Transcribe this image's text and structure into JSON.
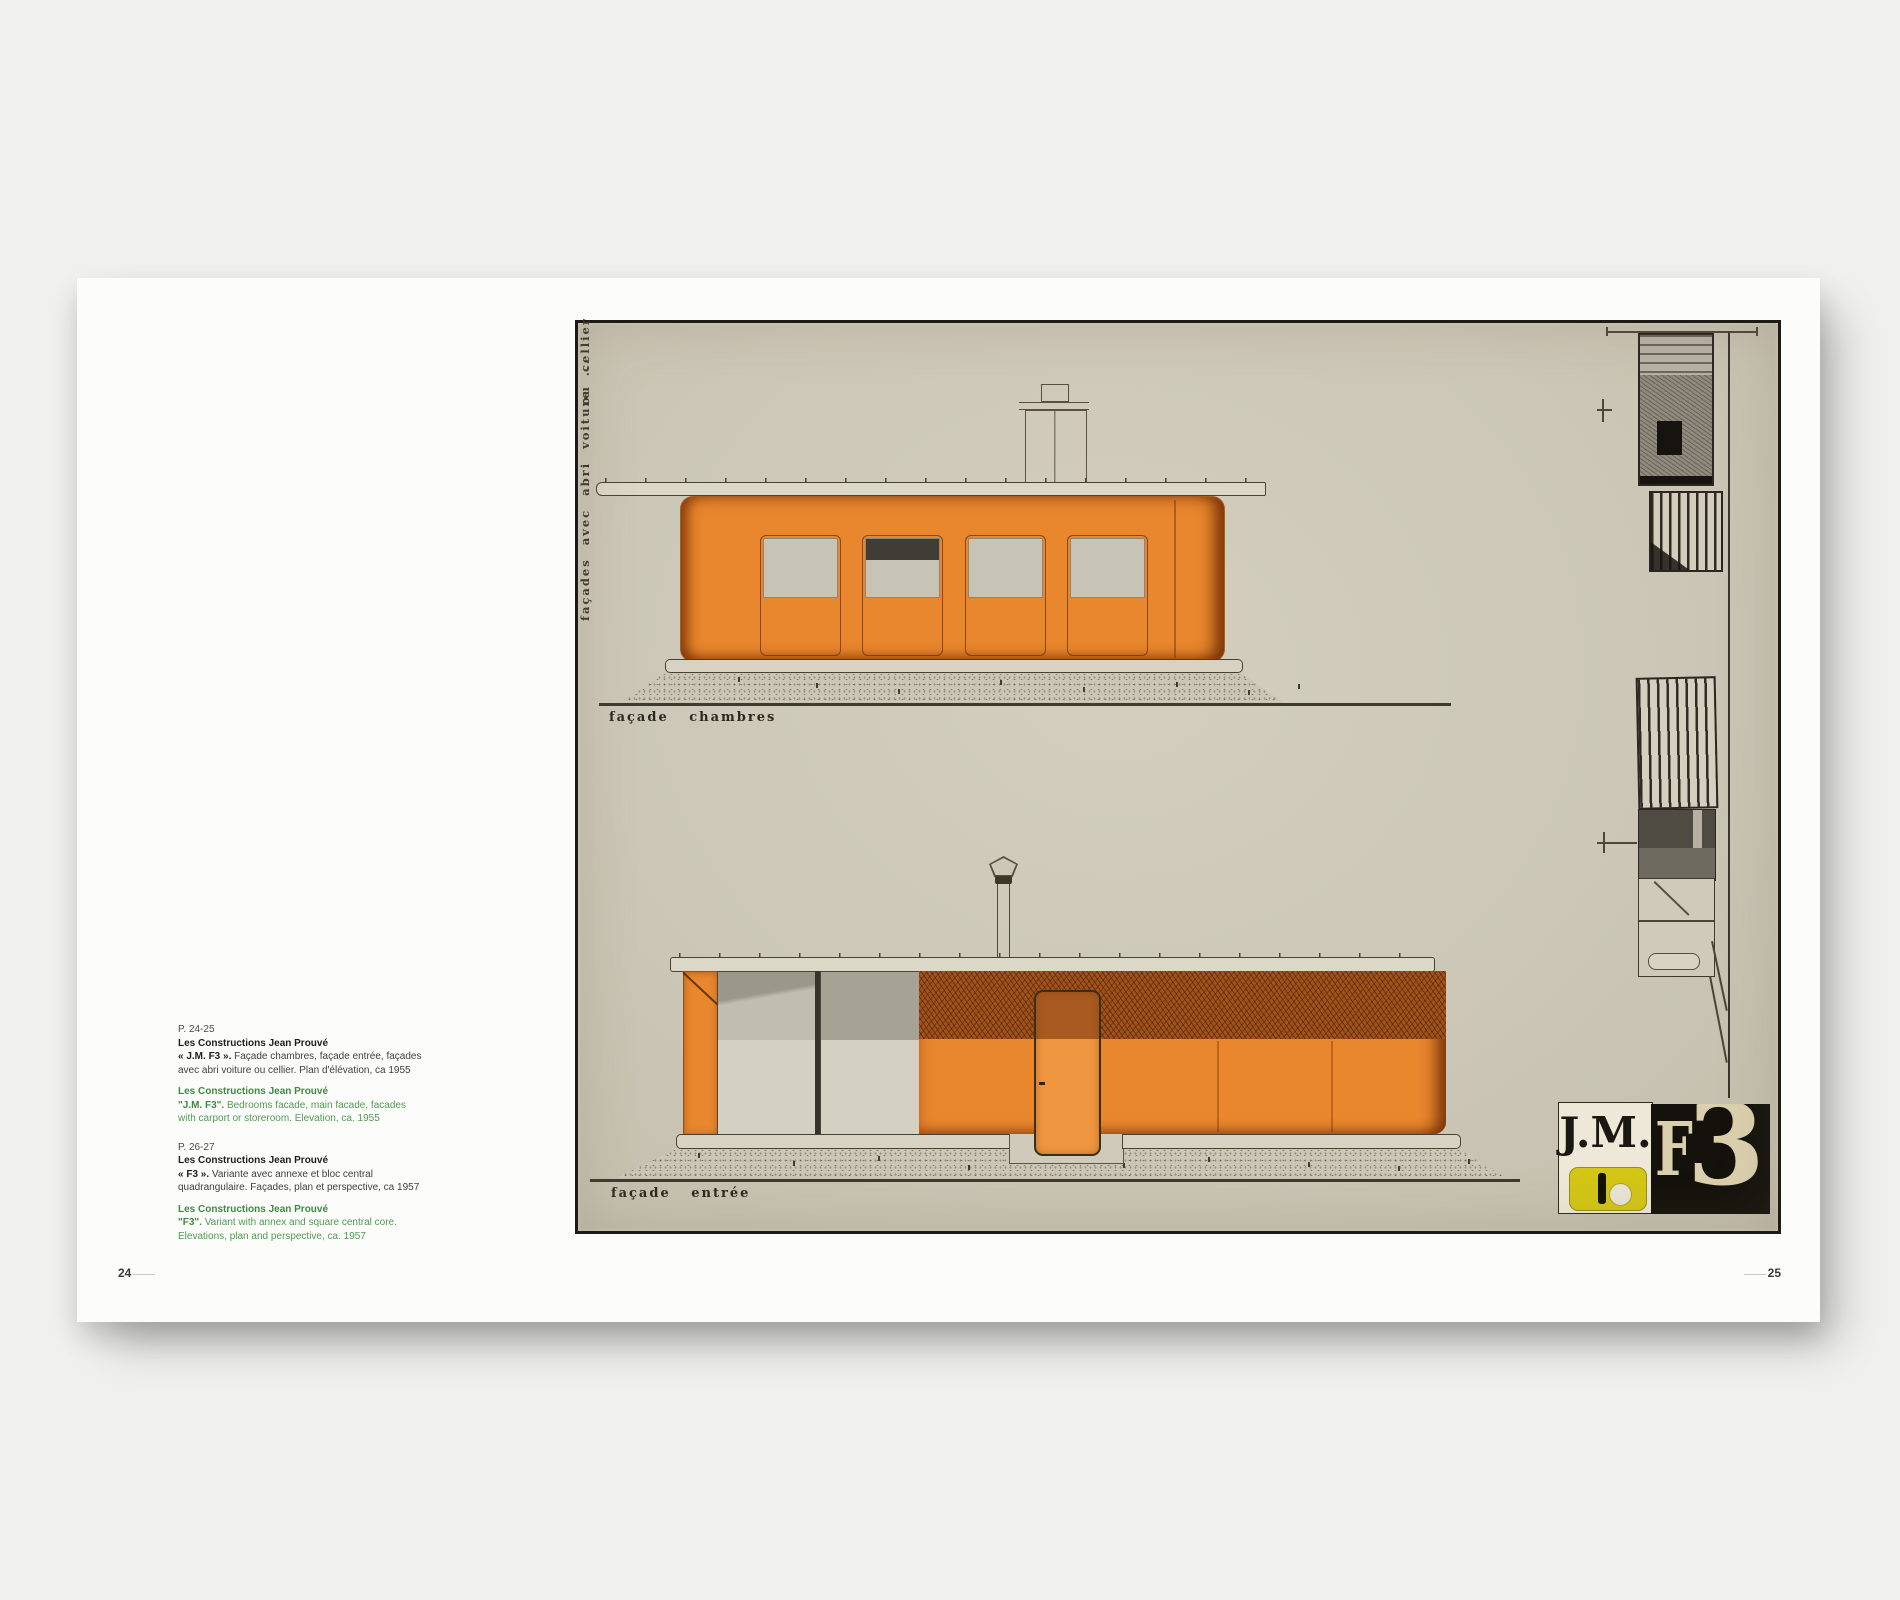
{
  "page_numbers": {
    "left": "24",
    "right": "25"
  },
  "captions": {
    "block1": {
      "page_ref": "P. 24-25",
      "fr_title": "Les Constructions Jean Prouvé",
      "fr_lead": "« J.M. F3 ».",
      "fr_rest": " Façade chambres, façade entrée, façades",
      "fr_line2": "avec abri voiture ou cellier. Plan d'élévation, ca 1955",
      "en_title": "Les Constructions Jean Prouvé",
      "en_lead": "\"J.M. F3\".",
      "en_rest": " Bedrooms facade, main facade, facades",
      "en_line2": "with carport or storeroom. Elevation, ca. 1955"
    },
    "block2": {
      "page_ref": "P. 26-27",
      "fr_title": "Les Constructions Jean Prouvé",
      "fr_lead": "« F3 ».",
      "fr_rest": " Variante avec annexe et bloc central",
      "fr_line2": "quadrangulaire. Façades, plan et perspective, ca 1957",
      "en_title": "Les Constructions Jean Prouvé",
      "en_lead": "\"F3\".",
      "en_rest": " Variant with annex and square central core.",
      "en_line2": "Elevations, plan and perspective, ca. 1957"
    }
  },
  "plate": {
    "label_top": "façade chambres",
    "label_bottom": "façade entrée",
    "side_caption_upper": "ou cellier",
    "side_caption_lower": "façades avec abri voiture ...",
    "logo": {
      "jm": "J.M.",
      "f": "F",
      "three": "3"
    }
  },
  "colors": {
    "background": "#f0f0ee",
    "page": "#fcfcfb",
    "plate_paper": "#ccc7b7",
    "orange": "#e8872e",
    "burnt_orange": "#a2521a",
    "ink": "#2e2a22",
    "logo_yellow": "#d3c616",
    "logo_black": "#15120d",
    "logo_cream": "#dbd0ae",
    "caption_green": "#4f9b51"
  }
}
